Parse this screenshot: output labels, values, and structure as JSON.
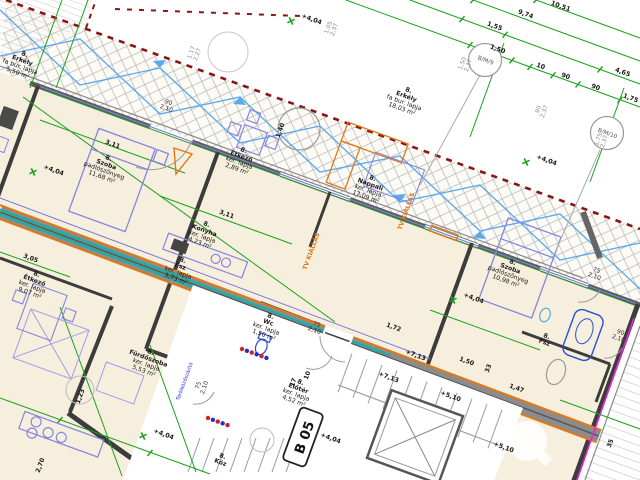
{
  "drawing": {
    "type": "architectural floor plan",
    "language": "Hungarian",
    "plan_rotation_deg": 20,
    "stamp": {
      "text": "B 05"
    },
    "colors": {
      "paper": "#ffffff",
      "floor": "#f7efdd",
      "dim_green": "#1aa11a",
      "boundary_red": "#8a1515",
      "accent_orange": "#e07818",
      "pipe_teal": "#17b0a6",
      "furniture_blue": "#8585e0",
      "wall_dark": "#3c3c3c",
      "magenta": "#e822d6",
      "hatch_gray": "#aeaeae"
    },
    "rooms": [
      {
        "id": "erkely-left",
        "x": 24,
        "y": 56,
        "lines": [
          "8.",
          "Erkély",
          "fa bur. lapja",
          "5,50 m²"
        ]
      },
      {
        "id": "erkely-right",
        "x": 408,
        "y": 92,
        "lines": [
          "8.",
          "Erkély",
          "fa bur. lapja",
          "18,03 m²"
        ]
      },
      {
        "id": "szoba-1",
        "x": 108,
        "y": 160,
        "lines": [
          "8.",
          "Szoba",
          "padlószőnyeg",
          "11,68 m²"
        ]
      },
      {
        "id": "etkezo-1",
        "x": 243,
        "y": 152,
        "lines": [
          "8.",
          "Étkező",
          "ker. lapja",
          "2,89 m²"
        ]
      },
      {
        "id": "nappali",
        "x": 372,
        "y": 180,
        "lines": [
          "8.",
          "Nappali",
          "ker. lapja",
          "17,09 m²"
        ]
      },
      {
        "id": "konyha",
        "x": 206,
        "y": 226,
        "lines": [
          "8.",
          "Konyha",
          "ker. lapja",
          "4,23 m²"
        ]
      },
      {
        "id": "fsz-1",
        "x": 182,
        "y": 262,
        "lines": [
          "8.",
          "Fsz",
          "ker. lapja",
          "3,73 m²"
        ]
      },
      {
        "id": "wc",
        "x": 270,
        "y": 318,
        "lines": [
          "8.",
          "Wc",
          "ker. lapja",
          "1,50 m²"
        ]
      },
      {
        "id": "furdoszoba",
        "x": 150,
        "y": 354,
        "lines": [
          "8.",
          "Fürdőszoba",
          "ker. lapja",
          "5,53 m²"
        ]
      },
      {
        "id": "eloter",
        "x": 300,
        "y": 384,
        "lines": [
          "8.",
          "Előtér",
          "ker. lapja",
          "4,52 m²"
        ]
      },
      {
        "id": "szoba-2",
        "x": 512,
        "y": 264,
        "lines": [
          "8.",
          "Szoba",
          "padlószőnyeg",
          "10,98 m²"
        ]
      },
      {
        "id": "etkezo-2",
        "x": 36,
        "y": 276,
        "lines": [
          "8.",
          "Étkező",
          "ker. lapja",
          "9,07 m²"
        ]
      },
      {
        "id": "fsz-2",
        "x": 546,
        "y": 338,
        "lines": [
          "8.",
          "Fsz"
        ]
      },
      {
        "id": "kozlekedo",
        "x": 222,
        "y": 458,
        "lines": [
          "8.",
          "Köz"
        ]
      }
    ],
    "chain_dims": [
      {
        "t": "10,51",
        "x": 560,
        "y": 8
      },
      {
        "t": "9,74",
        "x": 525,
        "y": 16
      },
      {
        "t": "1,55",
        "x": 494,
        "y": 28
      },
      {
        "t": "1,50",
        "x": 497,
        "y": 51
      },
      {
        "t": "10",
        "x": 540,
        "y": 68
      },
      {
        "t": "90",
        "x": 565,
        "y": 78
      },
      {
        "t": "90",
        "x": 595,
        "y": 89
      },
      {
        "t": "4,65",
        "x": 622,
        "y": 74
      },
      {
        "t": "1,75",
        "x": 630,
        "y": 100
      }
    ],
    "dims": [
      {
        "t": "3,11",
        "x": 112,
        "y": 146
      },
      {
        "t": "3,11",
        "x": 226,
        "y": 216
      },
      {
        "t": "3,05",
        "x": 30,
        "y": 260
      },
      {
        "t": "1,40",
        "x": 282,
        "y": 131,
        "r": -70
      },
      {
        "t": "1,23",
        "x": 82,
        "y": 397,
        "r": -70
      },
      {
        "t": "2,70",
        "x": 42,
        "y": 466,
        "r": -70
      },
      {
        "t": "1,50",
        "x": 466,
        "y": 363
      },
      {
        "t": "33",
        "x": 490,
        "y": 369,
        "r": -70
      },
      {
        "t": "1,47",
        "x": 516,
        "y": 390
      },
      {
        "t": "1,72",
        "x": 393,
        "y": 329
      },
      {
        "t": "35",
        "x": 612,
        "y": 444,
        "r": -70
      },
      {
        "t": "17",
        "x": 295,
        "y": 383,
        "r": -70
      },
      {
        "t": "10",
        "x": 309,
        "y": 376,
        "r": -70
      }
    ],
    "elevations": [
      {
        "t": "+4,04",
        "x": 53,
        "y": 172,
        "star": [
          33,
          172
        ]
      },
      {
        "t": "+4,04",
        "x": 311,
        "y": 21,
        "star": [
          291,
          21
        ]
      },
      {
        "t": "+4,04",
        "x": 546,
        "y": 162,
        "star": [
          526,
          162
        ]
      },
      {
        "t": "+4,04",
        "x": 473,
        "y": 300,
        "star": [
          453,
          300
        ]
      },
      {
        "t": "+4,04",
        "x": 163,
        "y": 436,
        "star": [
          143,
          436
        ]
      },
      {
        "t": "+4,04",
        "x": 330,
        "y": 440
      },
      {
        "t": "+7,13",
        "x": 415,
        "y": 357
      },
      {
        "t": "+7,13",
        "x": 388,
        "y": 379
      },
      {
        "t": "+5,10",
        "x": 450,
        "y": 398
      },
      {
        "t": "+5,10",
        "x": 503,
        "y": 449
      }
    ],
    "door_sizes": [
      {
        "lines": [
          "90",
          "2,10"
        ],
        "x": 168,
        "y": 104
      },
      {
        "lines": [
          "75",
          "2,10"
        ],
        "x": 316,
        "y": 326
      },
      {
        "lines": [
          "75",
          "2,10"
        ],
        "x": 596,
        "y": 272
      },
      {
        "lines": [
          "90",
          "2,10"
        ],
        "x": 620,
        "y": 334
      },
      {
        "lines": [
          "75",
          "2,10"
        ],
        "x": 200,
        "y": 386,
        "r": -70
      }
    ],
    "window_texts": [
      {
        "lines": [
          "1,50",
          "2,37"
        ],
        "x": 464,
        "y": 64,
        "r": -70
      },
      {
        "lines": [
          "90",
          "2,37"
        ],
        "x": 540,
        "y": 110,
        "r": -70
      },
      {
        "lines": [
          "1,75",
          "2,37"
        ],
        "x": 600,
        "y": 140,
        "r": -70
      },
      {
        "lines": [
          "1,05",
          "2,37"
        ],
        "x": 330,
        "y": 28,
        "r": -70
      },
      {
        "lines": [
          "1,17",
          "2,27"
        ],
        "x": 193,
        "y": 53,
        "r": -70
      }
    ],
    "window_tags": [
      {
        "t": "B/M/9",
        "x": 485,
        "y": 60
      },
      {
        "t": "B/M/10",
        "x": 607,
        "y": 133
      }
    ],
    "annotations": [
      {
        "t": "TV KIÁLLÁS",
        "x": 408,
        "y": 212,
        "r": -70,
        "c": "#e07818",
        "s": 6,
        "w": 700
      },
      {
        "t": "TV KIÁLLÁS",
        "x": 313,
        "y": 252,
        "r": -70,
        "c": "#e07818",
        "s": 6,
        "w": 700
      },
      {
        "t": "Törölközőszárító",
        "x": 186,
        "y": 382,
        "r": -70,
        "c": "#2828c8",
        "s": 5
      }
    ]
  }
}
